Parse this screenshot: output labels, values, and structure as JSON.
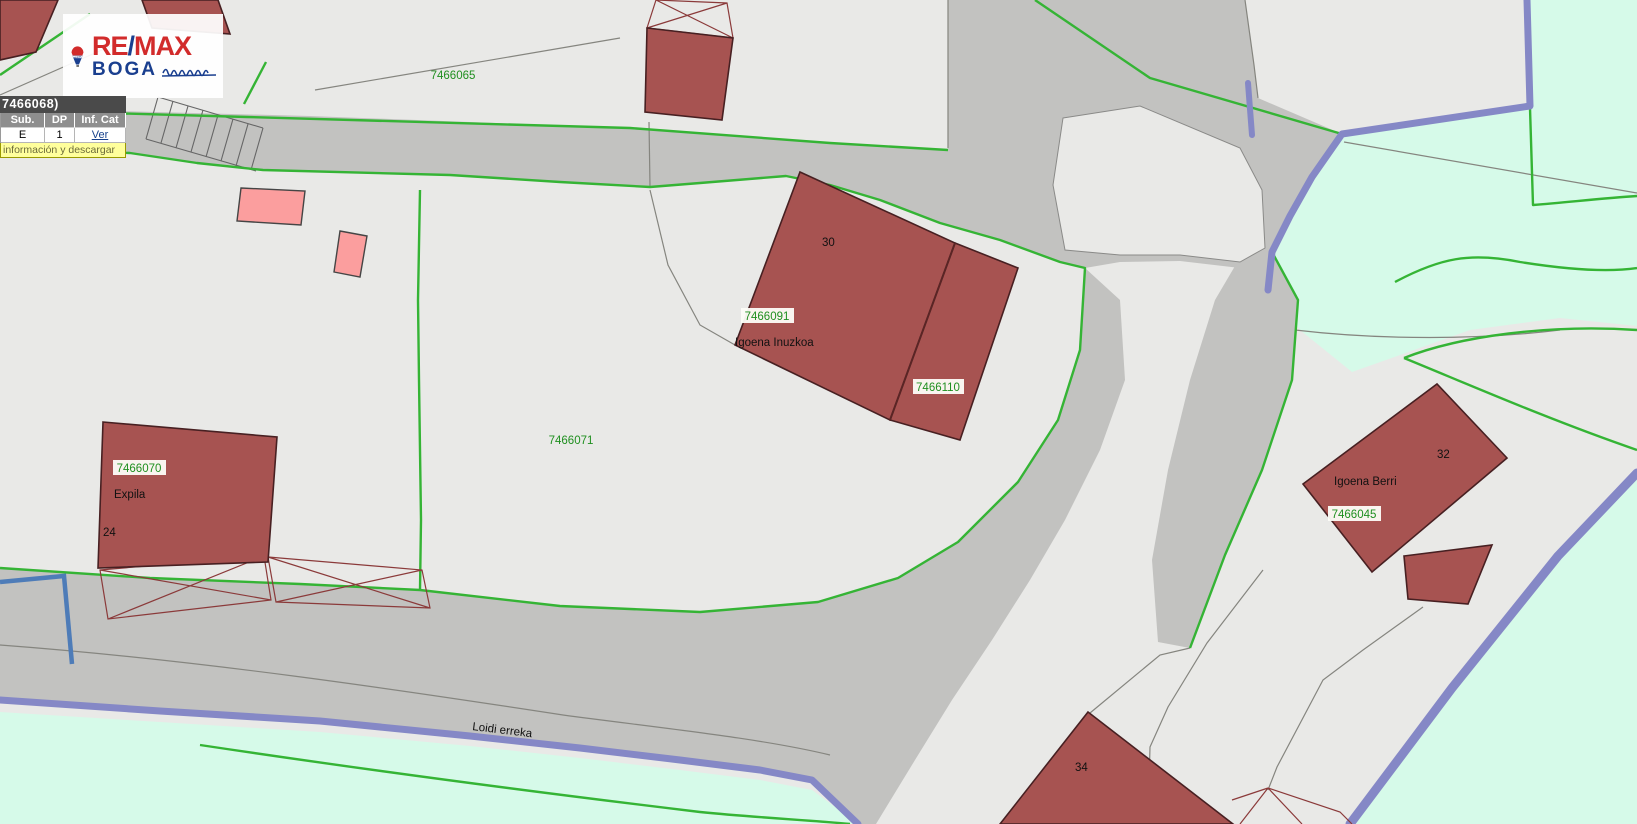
{
  "logo": {
    "primary_left": "RE",
    "primary_slash": "/",
    "primary_right": "MAX",
    "secondary": "BOGA",
    "balloon_text": "RE/MAX"
  },
  "popup": {
    "title": "7466068)",
    "headers": [
      "Sub.",
      "DP",
      "Inf. Cat"
    ],
    "row": {
      "sub": "E",
      "dp": "1",
      "inf_cat": "Ver"
    },
    "footer": "información y descargar"
  },
  "labels": {
    "parcels": {
      "p65": "7466065",
      "p71": "7466071",
      "p91": "7466091",
      "p110": "7466110",
      "p70": "7466070",
      "p45": "7466045"
    },
    "names": {
      "inuzkoa": "Igoena Inuzkoa",
      "expila": "Expila",
      "berri": "Igoena Berri",
      "stream": "Loidi erreka"
    },
    "numbers": {
      "n30": "30",
      "n24": "24",
      "n32": "32",
      "n34": "34"
    }
  },
  "colors": {
    "parcel_bg": "#E9E9E7",
    "road_grey": "#C2C2C0",
    "building_red": "#A75351",
    "building_pink": "#FB9E9E",
    "boundary_green": "#35B435",
    "boundary_purple": "#8588C6",
    "hydro_blue": "#4E7CB8",
    "water_cyan": "#D6FAE9",
    "label_green": "#1F8F1F",
    "hatch_red": "#8B3A3A",
    "popup_yellow": "#FFFF9C"
  }
}
